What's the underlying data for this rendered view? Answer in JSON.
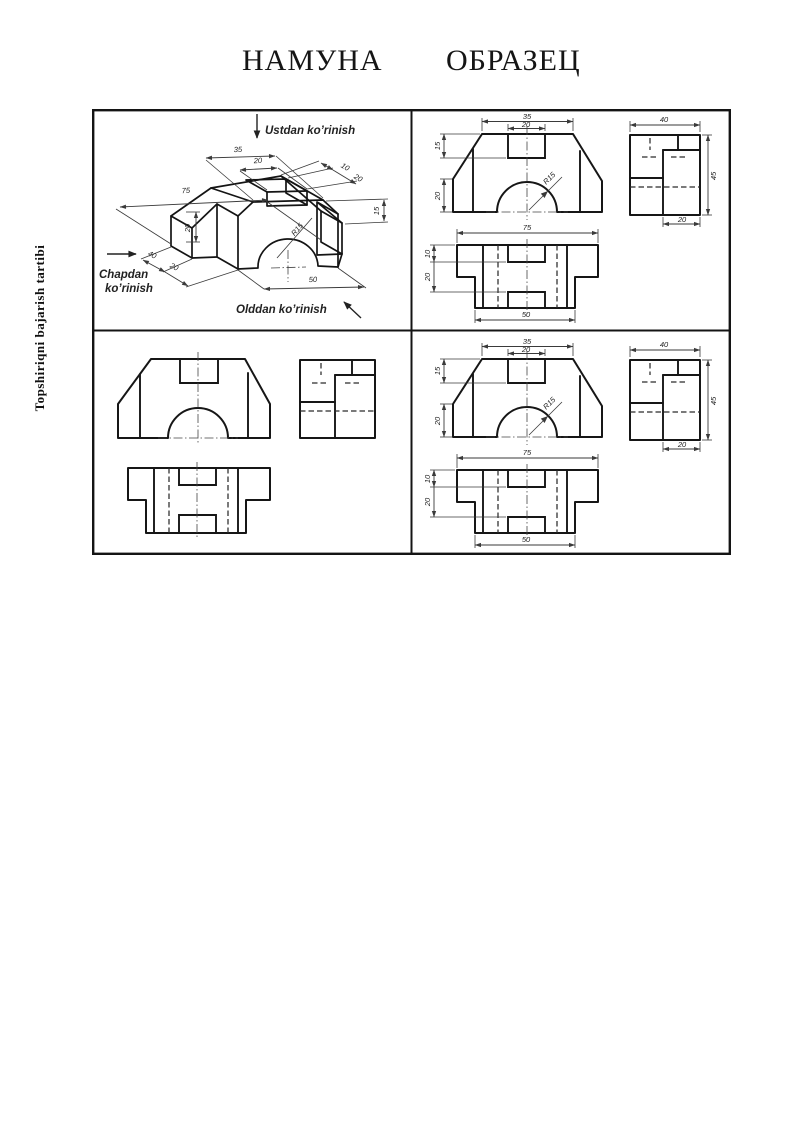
{
  "page": {
    "title_left": "НАМУНА",
    "title_right": "ОБРАЗЕЦ",
    "side_caption": "Topshiriqni bajarish tartibi"
  },
  "iso": {
    "label_top": "Ustdan ko’rinish",
    "label_left_line1": "Chapdan",
    "label_left_line2": "ko’rinish",
    "label_front": "Olddan ko’rinish",
    "dim_top_width": "35",
    "dim_notch_width": "20",
    "dim_length": "75",
    "dim_left_height": "20",
    "dim_notch_offset": "10",
    "dim_notch_len": "20",
    "dim_notch_depth": "15",
    "dim_depth": "40",
    "dim_front_depth": "20",
    "dim_bottom_width": "50",
    "dim_radius": "R15"
  },
  "ortho": {
    "front_top_width": "35",
    "front_notch_width": "20",
    "front_notch_depth": "15",
    "front_left_height": "20",
    "front_radius": "R15",
    "side_width": "40",
    "side_height": "45",
    "side_step": "20",
    "plan_length": "75",
    "plan_offset": "10",
    "plan_step": "20",
    "plan_bottom_width": "50"
  }
}
